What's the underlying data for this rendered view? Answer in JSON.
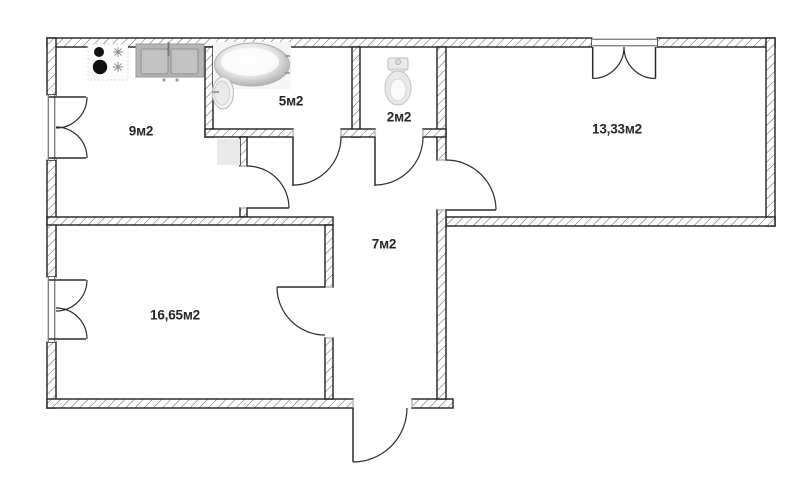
{
  "plan": {
    "type": "apartment-floor-plan",
    "rooms": [
      {
        "id": "kitchen",
        "label": "9м2"
      },
      {
        "id": "bathroom",
        "label": "5м2"
      },
      {
        "id": "toilet",
        "label": "2м2"
      },
      {
        "id": "room-right",
        "label": "13,33м2"
      },
      {
        "id": "hallway",
        "label": "7м2"
      },
      {
        "id": "room-left",
        "label": "16,65м2"
      }
    ],
    "fixtures": [
      {
        "id": "stove",
        "icon": "stove-icon"
      },
      {
        "id": "kitchen-sink",
        "icon": "sink-icon"
      },
      {
        "id": "bathtub",
        "icon": "bathtub-icon"
      },
      {
        "id": "washbasin",
        "icon": "washbasin-icon"
      },
      {
        "id": "toilet-bowl",
        "icon": "toilet-icon"
      },
      {
        "id": "appliance",
        "icon": "appliance-block"
      }
    ],
    "colors": {
      "wall_line": "#1f1f1f",
      "hatch_line": "#4a4a4a",
      "door_line": "#2b2b2b",
      "label_text": "#262626",
      "sink_gray": "#b5b5b5",
      "appliance_fill": "#e9e9e9",
      "background": "#ffffff"
    }
  }
}
